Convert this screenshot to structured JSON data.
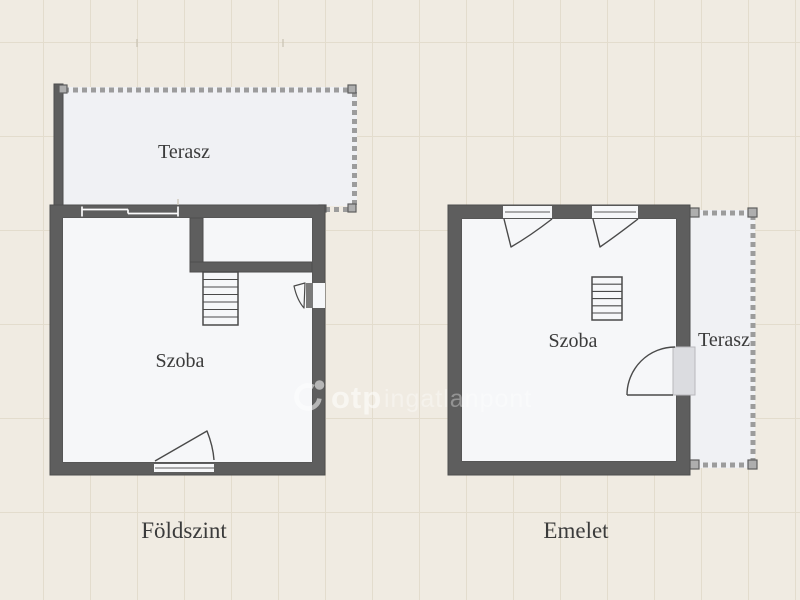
{
  "palette": {
    "background": "#f0ebe2",
    "grid_line": "#e3dccd",
    "wall": "#5e5e5e",
    "wall_edge": "#4d4d4d",
    "room_fill": "#f6f7f9",
    "terrace_fill": "#f0f1f4",
    "door_line": "#4a4a4a",
    "dash": "#9c9c9c",
    "label": "#3b3b3b",
    "watermark": "#ffffff"
  },
  "plans": {
    "ground_floor": {
      "caption": "Földszint",
      "room_label": "Szoba",
      "terrace_label": "Terasz"
    },
    "upper_floor": {
      "caption": "Emelet",
      "room_label": "Szoba",
      "terrace_label": "Terasz"
    }
  },
  "watermark": {
    "brand": "otp",
    "suffix": "ingatlanpont"
  }
}
